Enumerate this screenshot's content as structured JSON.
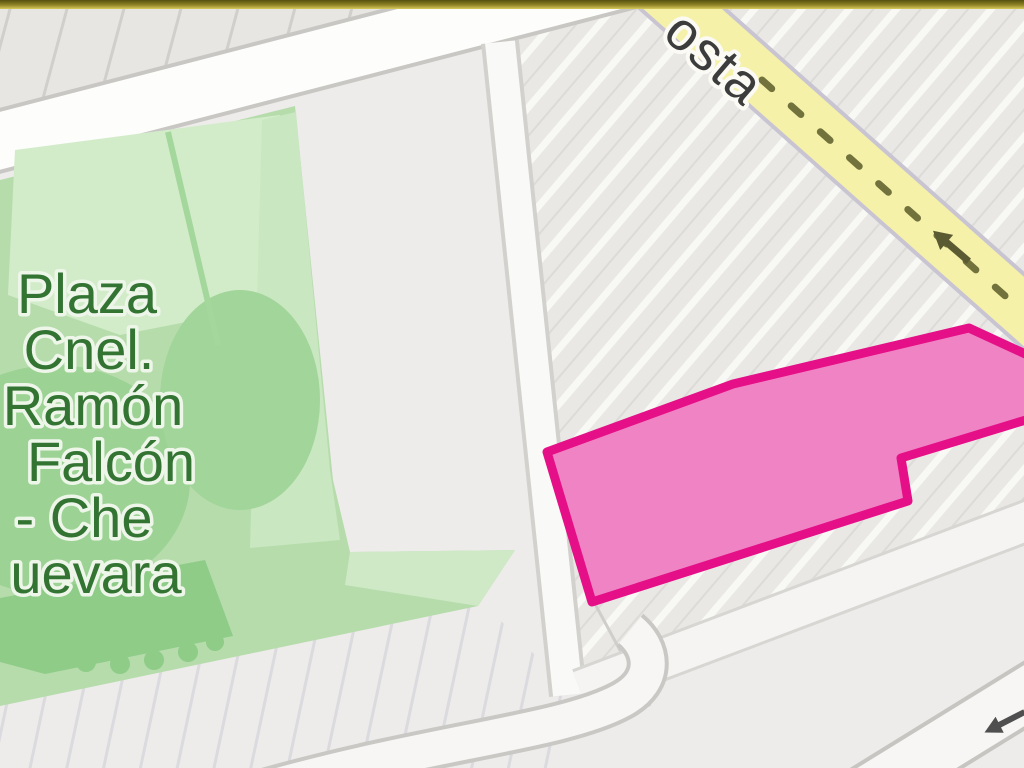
{
  "map": {
    "plaza": {
      "label_lines": [
        "Plaza",
        "Cnel.",
        "Ramón",
        "Falcón",
        "- Che",
        "uevara"
      ]
    },
    "streets": {
      "yellow_street_label_fragment": "osta"
    },
    "highlight": {
      "type": "parcel-outline",
      "fill": "#f083c3",
      "stroke": "#e50f87"
    },
    "colors": {
      "map_background": "#edecea",
      "block_gray": "#e9e8e5",
      "road_white": "#fdfdfb",
      "road_casing": "#c9c8c5",
      "road_yellow": "#f5f1a9",
      "plaza_green": "#b6dcac",
      "plaza_green_light": "#d2ecc9",
      "plaza_green_dark": "#8ecc88",
      "plaza_label_green": "#337433",
      "top_banner_dark": "#55500f",
      "top_banner_light": "#d8cb5c"
    }
  }
}
